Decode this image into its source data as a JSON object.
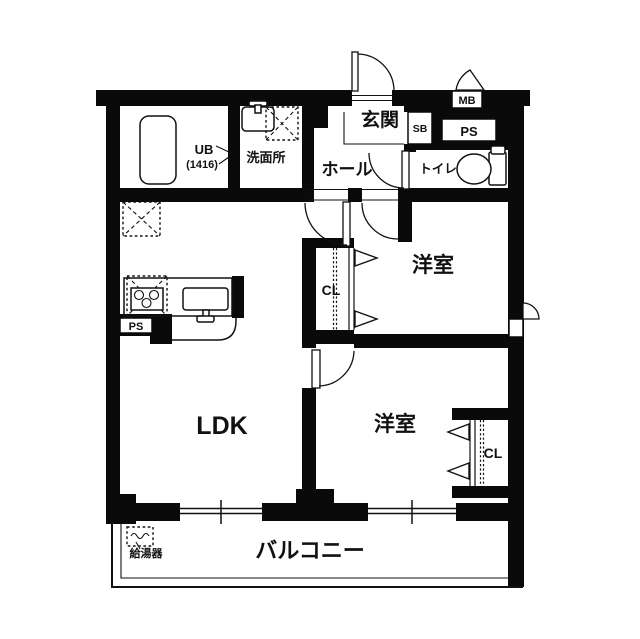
{
  "colors": {
    "wall": "#0a0a0a",
    "background": "#ffffff",
    "line": "#111111"
  },
  "rooms": {
    "unit_bath": {
      "label": "UB",
      "size": "(1416)"
    },
    "washroom": {
      "label": "洗面所"
    },
    "genkan": {
      "label": "玄関"
    },
    "hall": {
      "label": "ホール"
    },
    "toilet": {
      "label": "トイレ"
    },
    "bedroom_top": {
      "label": "洋室"
    },
    "bedroom_bottom": {
      "label": "洋室"
    },
    "closet_top": {
      "label": "CL"
    },
    "closet_bottom": {
      "label": "CL"
    },
    "ldk": {
      "label": "LDK"
    },
    "balcony": {
      "label": "バルコニー"
    }
  },
  "fixtures": {
    "meter_box": {
      "label": "MB"
    },
    "shoe_box": {
      "label": "SB"
    },
    "pipe_space_top": {
      "label": "PS"
    },
    "pipe_space_kitchen": {
      "label": "PS"
    },
    "water_heater": {
      "label": "給湯器"
    }
  }
}
